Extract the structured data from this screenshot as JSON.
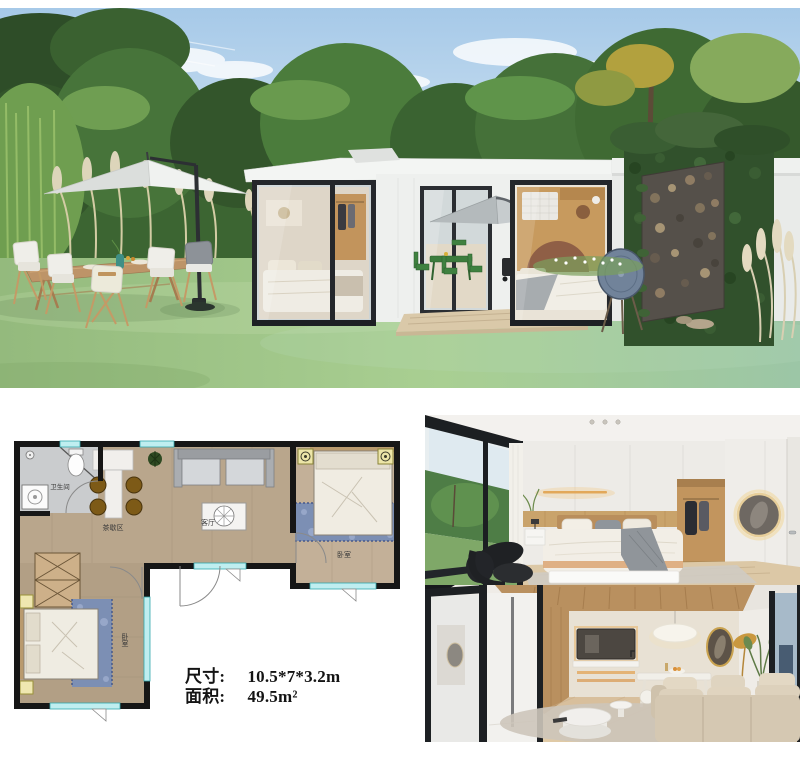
{
  "specs": {
    "dimensions_label": "尺寸:",
    "dimensions_value": "10.5*7*3.2m",
    "area_label": "面积:",
    "area_value": "49.5m²"
  },
  "floor_plan": {
    "labels": {
      "bathroom": "卫生间",
      "tea_area": "茶歇区",
      "living_room": "客厅",
      "bedroom_right": "卧室",
      "bedroom_left": "卧室"
    },
    "colors": {
      "wall": "#161616",
      "window_glass": "#bfeef0",
      "window_frame": "#33a7ad",
      "wood_floor": "#b9a68c",
      "bathroom_floor": "#caccce",
      "rug_blue": "#7c8fb4",
      "stool_brown": "#7d5a17"
    }
  },
  "palette": {
    "sky": "#a6c9e8",
    "lawn_green": "#a9cf92",
    "tree_green": "#3f6a33",
    "house_white": "#eef0ee",
    "sign_red": "#b23229"
  }
}
